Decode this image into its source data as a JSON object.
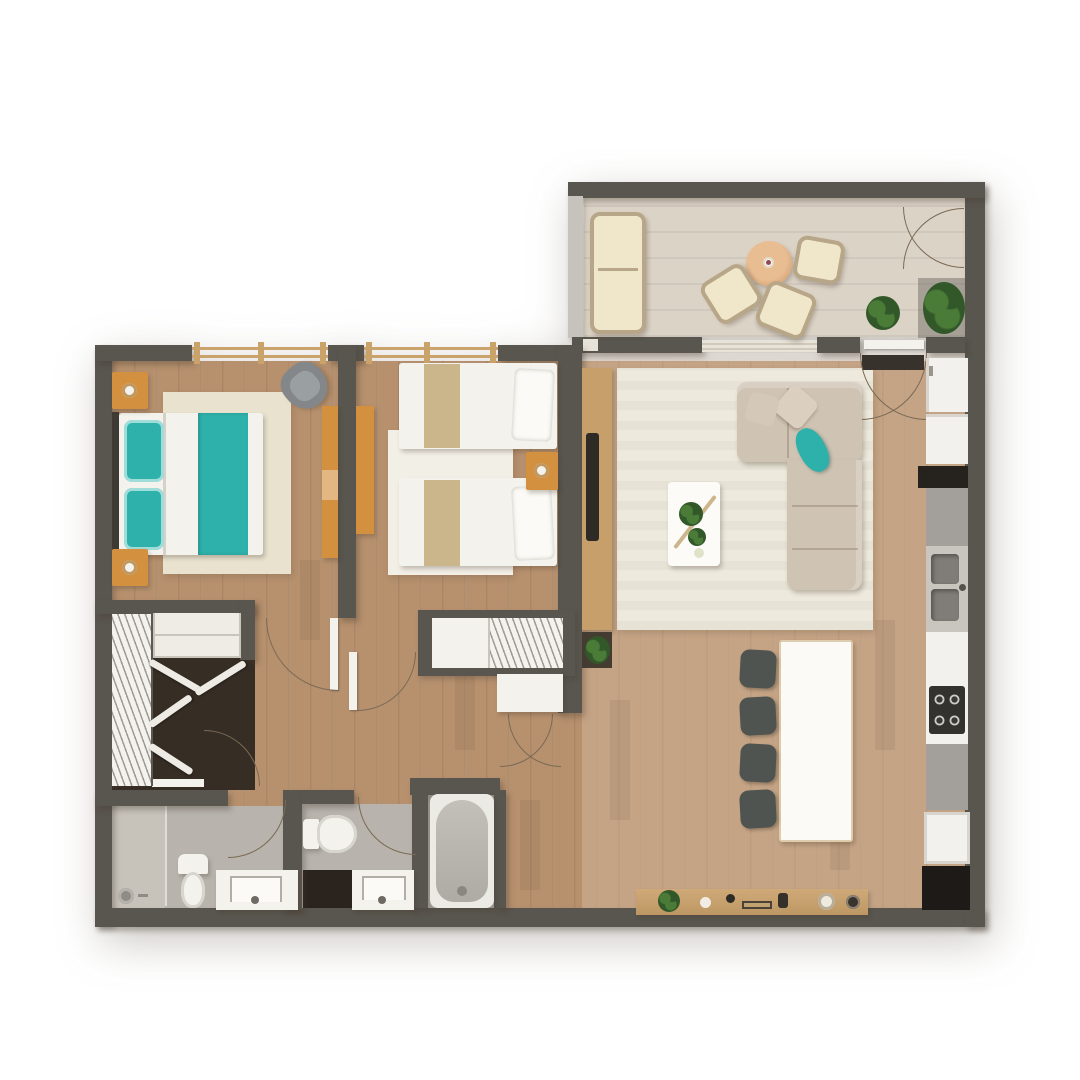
{
  "scene": {
    "type": "architectural-floor-plan-top-view",
    "style": "3d-rendered-2d-apartment-plan",
    "background": "#ffffff",
    "visible_text": []
  },
  "palette": {
    "wall": "#59564f",
    "wallLight": "#c6c3bd",
    "wood": "#b7916e",
    "balconyFloor": "#dcd3c7",
    "rugLiving": "#ede9dc",
    "rugBed1": "#e8e2cf",
    "rugBed2": "#f2efe7",
    "bathFloor": "#b8b4ad",
    "showerFloor": "#c7c3bb",
    "closetFloor": "#362d25",
    "showerDark": "#2b241e",
    "white": "#f4f2ed",
    "orange": "#d3913f",
    "teal": "#2eb1aa",
    "tan": "#cbb68c",
    "sofa": "#cfc3b3",
    "grayChair": "#83878a",
    "diningChair": "#4f5451",
    "counterGray": "#a3a09b",
    "sinkGray": "#807d78",
    "appliance": "#f2f1ed",
    "darkUnit": "#26221d",
    "windowFrame": "#c9a36a",
    "plant": "#4a7c38",
    "plantDark": "#32582a",
    "wicker": "#b7a687",
    "cushion": "#f0e7cb",
    "woodAccent": "#c79f6b",
    "tvDark": "#2e2a26",
    "arc": "#7a6a55",
    "mat": "#37332c"
  },
  "counts": {
    "dining_chairs": 4,
    "cooktop_burners": 4,
    "balcony_chairs": 3,
    "balcony_plants": 2,
    "twin_beds": 2,
    "master_nightstands": 2
  },
  "rooms": [
    {
      "id": "balcony",
      "furniture": [
        "wicker-sofa",
        "round-table",
        "chair",
        "chair",
        "chair",
        "plant",
        "plant",
        "french-doors"
      ]
    },
    {
      "id": "master-bedroom",
      "furniture": [
        "double-bed",
        "teal-runner",
        "teal-pillows",
        "nightstand-lamp",
        "nightstand-lamp",
        "armchair",
        "desk",
        "rug"
      ]
    },
    {
      "id": "bedroom-2",
      "furniture": [
        "twin-bed",
        "twin-bed",
        "nightstand-lamp",
        "desk",
        "rug",
        "built-in-closet"
      ]
    },
    {
      "id": "walk-in-closet",
      "furniture": [
        "wardrobe-rail",
        "shelving",
        "folding-doors"
      ]
    },
    {
      "id": "bathroom-1",
      "furniture": [
        "shower",
        "toilet",
        "vanity-sink"
      ]
    },
    {
      "id": "bathroom-2",
      "furniture": [
        "toilet",
        "vanity-sink",
        "dark-shower-tray",
        "bathtub"
      ]
    },
    {
      "id": "living-room",
      "furniture": [
        "tv-console",
        "tv",
        "corner-sofa",
        "teal-pillow",
        "coffee-table",
        "rug",
        "doormat",
        "sideboard"
      ]
    },
    {
      "id": "dining-area",
      "furniture": [
        "dining-table",
        "chairs-x4"
      ]
    },
    {
      "id": "kitchen",
      "furniture": [
        "fridge",
        "appliance",
        "counter",
        "double-sink",
        "gas-cooktop",
        "oven",
        "dark-cabinet"
      ]
    }
  ]
}
